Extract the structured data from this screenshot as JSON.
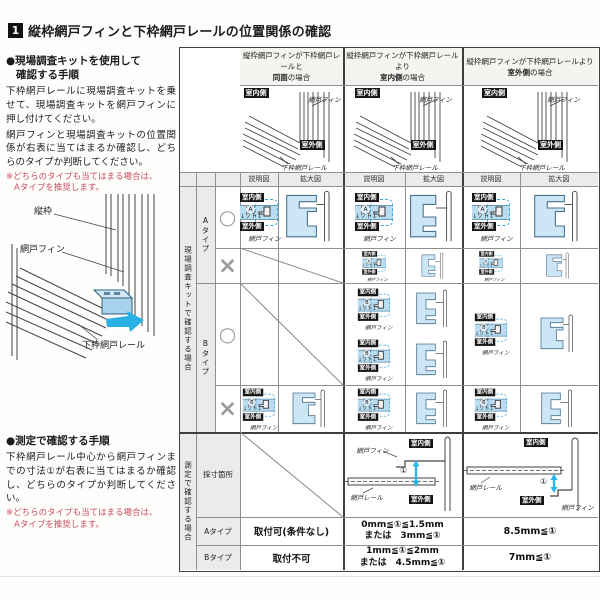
{
  "page": {
    "number_badge": "1",
    "title": "縦枠網戸フィンと下枠網戸レールの位置関係の確認"
  },
  "left": {
    "kit_method": {
      "heading1": "●現場調査キットを使用して",
      "heading2": "確認する手順",
      "para1": "下枠網戸レールに現場調査キットを乗せて、現場調査キットを網戸フィンに押し付けてください。",
      "para2": "網戸フィンと現場調査キットの位置関係が右表に当てはまるか確認し、どちらのタイプか判断してください。",
      "note1": "※どちらのタイプも当てはまる場合は、",
      "note2": "Aタイプを推奨します。"
    },
    "diagram_labels": {
      "frame": "縦枠",
      "fin": "網戸フィン",
      "rail": "下枠網戸レール"
    },
    "measure_method": {
      "heading": "●測定で確認する手順",
      "para": "下枠網戸レール中心から網戸フィンまでの寸法①が右表に当てはまるか確認し、どちらのタイプか判断してください。",
      "note1": "※どちらのタイプも当てはまる場合は、",
      "note2": "Aタイプを推奨します。"
    }
  },
  "table": {
    "cases": [
      {
        "title1": "縦枠網戸フィンが下枠網戸レールと",
        "title2_em": "同面",
        "title2_rest": "の場合"
      },
      {
        "title1": "縦枠網戸フィンが下枠網戸レールより",
        "title2_em": "室内側",
        "title2_rest": "の場合"
      },
      {
        "title1": "縦枠網戸フィンが下枠網戸レールより",
        "title2_em": "室外側",
        "title2_rest": "の場合"
      }
    ],
    "sub_headers": {
      "schematic": "説明図",
      "enlarged": "拡大図"
    },
    "badges": {
      "indoor": "室内側",
      "outdoor": "室外側"
    },
    "labels": {
      "fin": "網戸フィン",
      "rail": "下枠網戸レール",
      "rail_short": "網戸レール",
      "soto": "↓ソト↓",
      "dim": "①"
    },
    "letters": {
      "A": "A",
      "B": "B"
    },
    "kit_section": {
      "group": "現場調査キットで確認する場合",
      "type_a": "Aタイプ",
      "type_b": "Bタイプ",
      "ok": "○",
      "ng": "×"
    },
    "measure_section": {
      "group": "測定で確認する場合",
      "row_point": "採寸箇所",
      "row_a": "Aタイプ",
      "row_b": "Bタイプ",
      "values": {
        "case1_a": "取付可(条件なし)",
        "case1_b": "取付不可",
        "case2_a1": "0mm≦①≦1.5mm",
        "case2_a2": "または　3mm≦①",
        "case2_b1": "1mm≦①≦2mm",
        "case2_b2": "または　4.5mm≦①",
        "case3_a": "8.5mm≦①",
        "case3_b": "7mm≦①"
      }
    }
  }
}
